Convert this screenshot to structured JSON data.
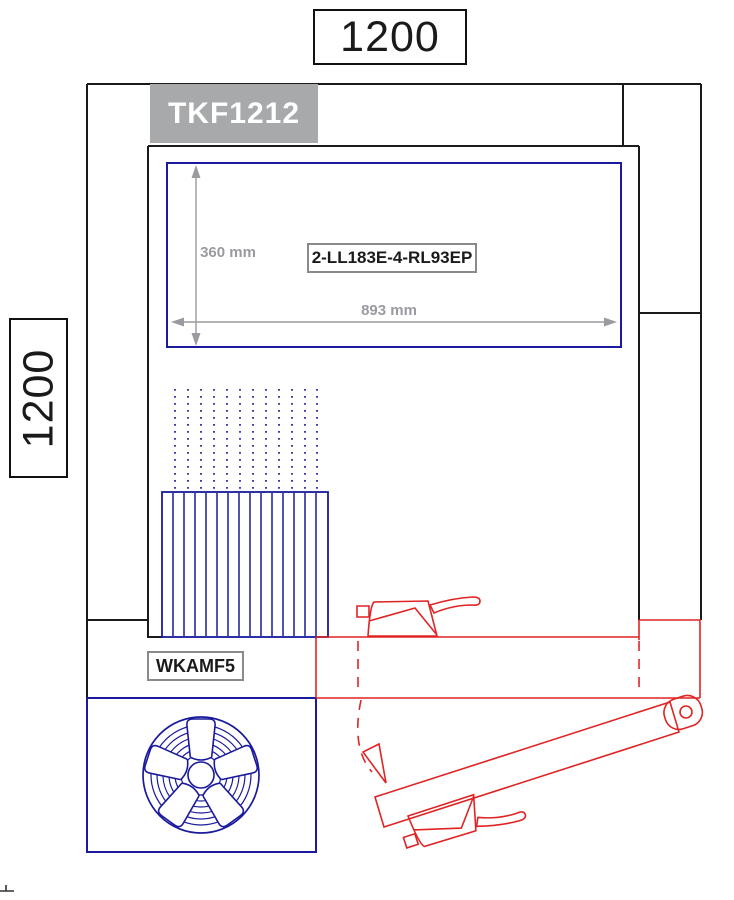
{
  "dimensions": {
    "overall_width": "1200",
    "overall_depth": "1200",
    "evaporator_depth": "360 mm",
    "evaporator_width": "893 mm"
  },
  "labels": {
    "unit_model": "TKF1212",
    "evaporator_model": "2-LL183E-4-RL93EP",
    "door_model": "WKAMF5"
  },
  "colors": {
    "blue": "#1a1a9c",
    "red": "#e02424",
    "wall": "#1a1a1a",
    "dim": "#9a9aa0",
    "model-box-fill": "#a7a9ab",
    "model-box-text": "#ffffff",
    "label-border": "#8a8a8a",
    "text": "#1a1a1a",
    "bg": "#ffffff"
  }
}
